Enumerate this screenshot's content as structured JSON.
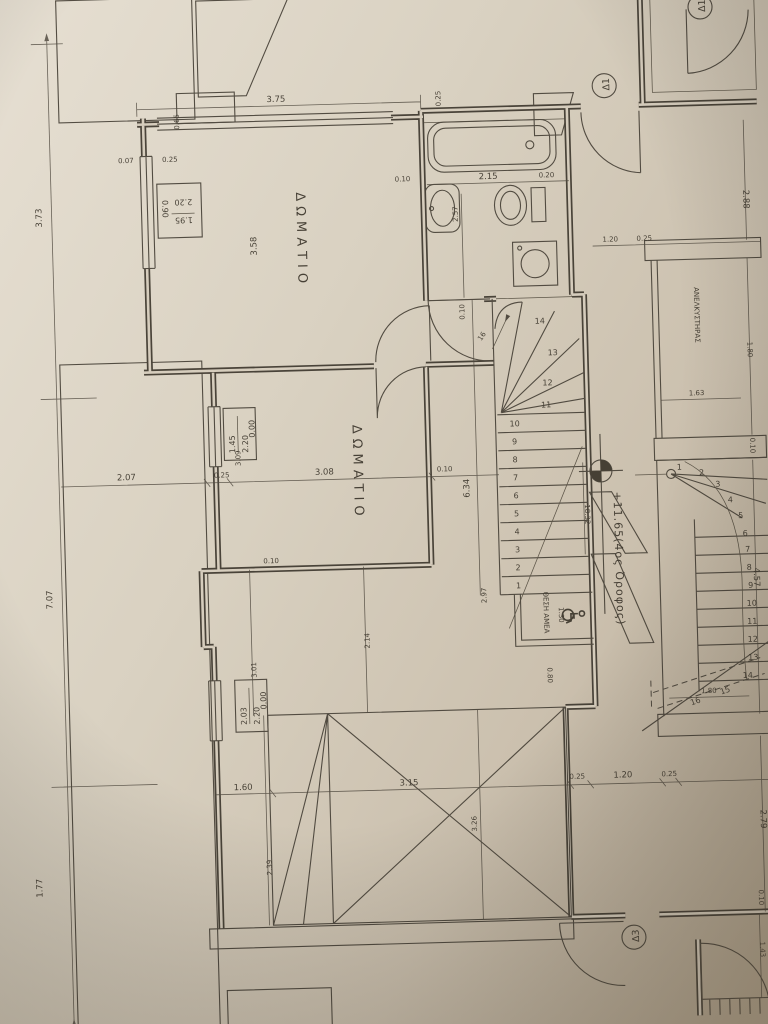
{
  "drawing": {
    "labels": {
      "room1": "ΔΩΜΑΤΙΟ",
      "room2": "ΔΩΜΑΤΙΟ",
      "elevator": "ΑΝΕΛΚΥΣΤΗΡΑΣ",
      "amea": "ΘΕΣΗ ΑΜΕΑ",
      "level": "+11.65(4ος Όροφος)"
    },
    "door_tags": {
      "d1a": "Δ1",
      "d1b": "Δ1",
      "d3": "Δ3"
    },
    "schedules": {
      "s1": {
        "num": "1.95",
        "den": "2.20",
        "side": "0.90"
      },
      "s2": {
        "num": "1.45",
        "den": "2.20",
        "side": "0.00"
      },
      "s3": {
        "num": "2.03",
        "den": "2.20",
        "side": "0.00"
      }
    },
    "stairs": {
      "left_steps": [
        "1",
        "2",
        "3",
        "4",
        "5",
        "6",
        "7",
        "8",
        "9",
        "10",
        "11",
        "12",
        "13",
        "14"
      ],
      "left_riser_count": "16",
      "right_steps": [
        "1",
        "2",
        "3",
        "4",
        "5",
        "6",
        "7",
        "8",
        "9",
        "10",
        "11",
        "12",
        "13",
        "14",
        "15",
        "16"
      ]
    },
    "dims": {
      "left_top": "3.73",
      "left_mid": "7.07",
      "left_bottom": "1.77",
      "top_width": "3.75",
      "top_a": "0.07",
      "top_b": "0.25",
      "top_c": "0.65",
      "room1_h": "3.58",
      "bath_a": "0.10",
      "bath_w": "2.15",
      "bath_h": "2.57",
      "bath_b": "0.20",
      "bath_c": "0.25",
      "mid_a": "2.07",
      "mid_b": "0.25",
      "mid_c": "3.08",
      "mid_d": "0.10",
      "mid_e": "3.09",
      "mid_f": "0.10",
      "stair_l": "6.34",
      "stair_w": "2.97",
      "stair_a": "0.10",
      "stair_run": "18.32",
      "amea_a": "1.30",
      "amea_b": "0.80",
      "ll_a": "3.01",
      "ll_b": "2.14",
      "ll_c": "2.39",
      "bot_a": "1.60",
      "bot_b": "3.15",
      "bot_c": "0.25",
      "bot_d": "1.20",
      "bot_e": "0.25",
      "roof_h": "3.26",
      "rt_h": "2.88",
      "rt_a": "1.20",
      "rt_b": "0.25",
      "el_w": "1.63",
      "el_h": "1.80",
      "el_a": "0.10",
      "rs_h": "4.57",
      "rs_w": "1.80",
      "rb_h": "2.79",
      "rb_a": "1.43",
      "rb_b": "0.10"
    }
  }
}
